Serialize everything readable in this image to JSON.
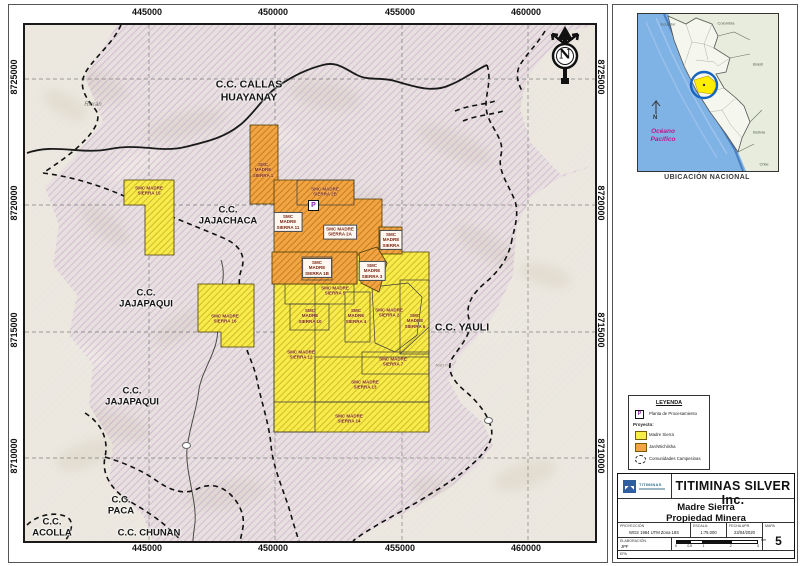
{
  "map": {
    "x_ticks": [
      "445000",
      "450000",
      "455000",
      "460000"
    ],
    "y_ticks": [
      "8725000",
      "8720000",
      "8715000",
      "8710000"
    ],
    "north_letter": "N",
    "marker_p": "P",
    "communities": {
      "callas": "C.C. CALLAS\nHUAYANAY",
      "jajachaca": "C.C.\nJAJACHACA",
      "jajapaqui_n": "C.C.\nJAJAPAQUI",
      "jajapaqui_s": "C.C.\nJAJAPAQUI",
      "yauli": "C.C. YAULI",
      "paca": "C.C.\nPACA",
      "chunan": "C.C. CHUNAN",
      "acolla": "C.C.\nACOLLA"
    },
    "places": {
      "ricran": "Ricrán",
      "elevation": "4587 m"
    },
    "claims": [
      {
        "name": "SMC\nMADRE\nSIERRA 1"
      },
      {
        "name": "SMC MADRE\nSIERRA 2B"
      },
      {
        "name": "SMC\nMADRE\nSIERRA 11"
      },
      {
        "name": "SMC MADRE\nSIERRA 2A"
      },
      {
        "name": "SMC\nMADRE\nSIERRA"
      },
      {
        "name": "SMC\nMADRE\nSIERRA 1B"
      },
      {
        "name": "SMC\nMADRE\nSIERRA 3"
      },
      {
        "name": "SMC MADRE\nSIERRA 15"
      },
      {
        "name": "SMC MADRE\nSIERRA 16"
      },
      {
        "name": "SMC MADRE\nSIERRA 5"
      },
      {
        "name": "SMC\nMADRE\nSIERRA 10"
      },
      {
        "name": "SMC\nMADRE\nSIERRA 4"
      },
      {
        "name": "SMC MADRE\nSIERRA 2"
      },
      {
        "name": "SMC\nMADRE\nSIERRA 6"
      },
      {
        "name": "SMC MADRE\nSIERRA 12"
      },
      {
        "name": "SMC MADRE\nSIERRA 7"
      },
      {
        "name": "SMC MADRE\nSIERRA 13"
      },
      {
        "name": "SMC MADRE\nSIERRA 14"
      }
    ]
  },
  "inset": {
    "caption": "UBICACIÓN NACIONAL",
    "ocean": "Océano\nPacífico",
    "north_letter": "N",
    "countries": {
      "ecuador": "Ecuador",
      "colombia": "Colombia",
      "brasil": "Brasil",
      "bolivia": "Bolivia",
      "chile": "Chile"
    }
  },
  "legend": {
    "title": "LEYENDA",
    "marker_p": "P",
    "item_plant": "Planta de Procesamiento",
    "group_label": "Proyecto:",
    "item_madre_sierra": "Madre Sierra",
    "item_second": "Jan/Wichilsha",
    "item_communities": "Comunidades Campesinas"
  },
  "titleblock": {
    "logo_text": "TITIMINAS",
    "company": "TITIMINAS SILVER Inc.",
    "project": "Madre Sierra",
    "subtitle": "Propiedad Minera",
    "fields": {
      "proj_label": "PROYECCIÓN",
      "proj_value": "WGS 1984 UTM Zona 18S",
      "scale_label": "ESCALA:",
      "scale_value": "1:75.000",
      "date_label": "FECHA APR.",
      "date_value": "23/04/2020",
      "map_label": "MAPA",
      "map_value": "5",
      "elab_label": "ELABORACIÓN",
      "elab_value": "JPF",
      "footer": "EPA"
    },
    "scalebar": {
      "t0": "0",
      "t1": "0.5",
      "t2": "1",
      "t3": "2",
      "t4": "3",
      "unit": "Km"
    }
  },
  "colors": {
    "claim_yellow": "#f8ec4a",
    "claim_orange": "#f1a643",
    "hatch_line": "#bb93bd",
    "ocean_blue": "#7fb2e5",
    "marker_purple": "#8e24aa"
  }
}
